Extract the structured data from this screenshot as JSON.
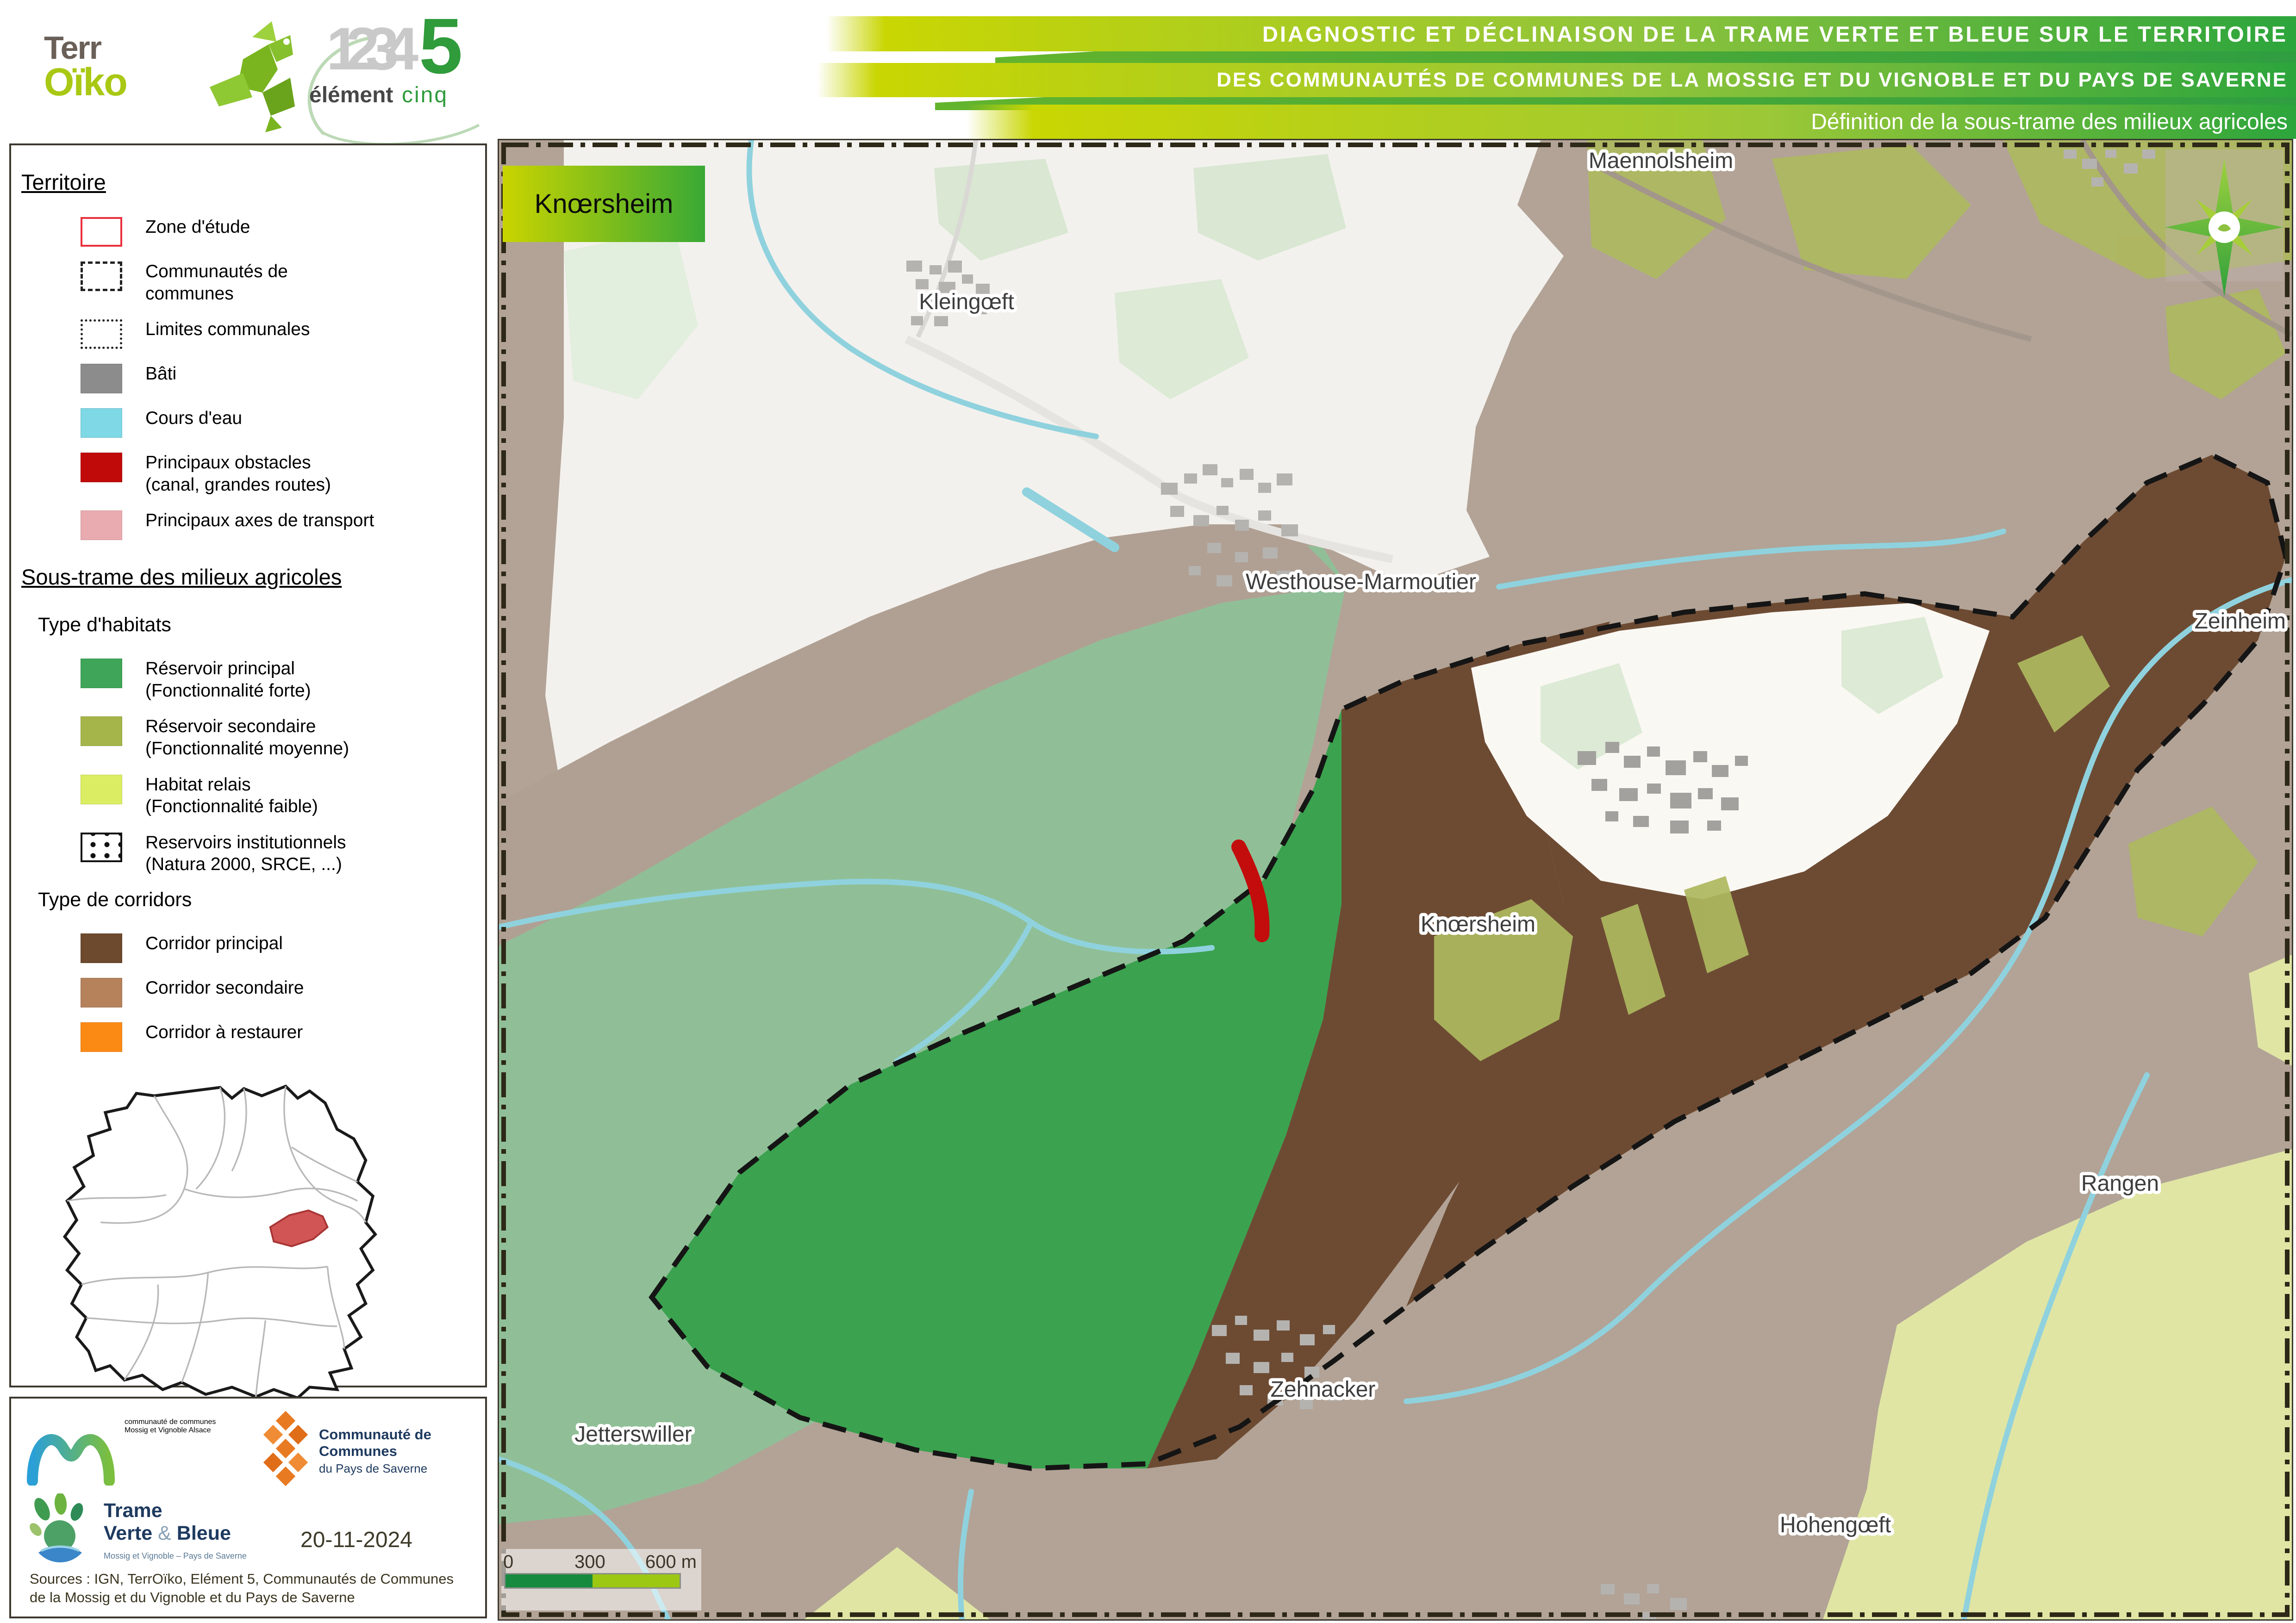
{
  "header": {
    "logo_terroiko": {
      "part1": "Terr",
      "part2": "Oïko"
    },
    "logo_element5": {
      "numbers": "1234",
      "five": "5",
      "word1": "élément",
      "word2": "cinq"
    },
    "title_line1": "DIAGNOSTIC ET DÉCLINAISON DE LA TRAME VERTE ET BLEUE SUR LE TERRITOIRE",
    "title_line2": "DES COMMUNAUTÉS DE COMMUNES DE LA MOSSIG ET DU VIGNOBLE ET DU PAYS DE SAVERNE",
    "title_line3": "Définition de la sous-trame des milieux agricoles"
  },
  "legend": {
    "territoire": {
      "title": "Territoire",
      "items": [
        {
          "label": "Zone d'étude",
          "swatch": "outline-red",
          "color": "#e8303c"
        },
        {
          "label": "Communautés de communes",
          "swatch": "dashed",
          "color": "#222222"
        },
        {
          "label": "Limites communales",
          "swatch": "dotted",
          "color": "#222222"
        },
        {
          "label": "Bâti",
          "swatch": "fill",
          "color": "#8c8c8c"
        },
        {
          "label": "Cours d'eau",
          "swatch": "fill",
          "color": "#7fd8e5"
        },
        {
          "label": "Principaux obstacles",
          "sublabel": "(canal, grandes routes)",
          "swatch": "fill",
          "color": "#c00a0a"
        },
        {
          "label": "Principaux axes de transport",
          "swatch": "fill",
          "color": "#e9abb0"
        }
      ]
    },
    "soustrame": {
      "title": "Sous-trame des milieux agricoles",
      "habitats": {
        "title": "Type d'habitats",
        "items": [
          {
            "label": "Réservoir principal",
            "sublabel": "(Fonctionnalité forte)",
            "color": "#3fa558"
          },
          {
            "label": "Réservoir secondaire",
            "sublabel": "(Fonctionnalité moyenne)",
            "color": "#a6b549"
          },
          {
            "label": "Habitat relais",
            "sublabel": "(Fonctionnalité faible)",
            "color": "#dbed62"
          },
          {
            "label": "Reservoirs institutionnels",
            "sublabel": "(Natura 2000, SRCE, ...)",
            "swatch": "dots"
          }
        ]
      },
      "corridors": {
        "title": "Type de corridors",
        "items": [
          {
            "label": "Corridor principal",
            "color": "#6d4a2d"
          },
          {
            "label": "Corridor secondaire",
            "color": "#b5825c"
          },
          {
            "label": "Corridor à restaurer",
            "color": "#fb8a15"
          }
        ]
      }
    }
  },
  "map": {
    "title_box": "Knœrsheim",
    "labels": {
      "maennolsheim": "Maennolsheim",
      "kleingoeft": "Kleingœft",
      "westhouse": "Westhouse-Marmoutier",
      "zeinheim": "Zeinheim",
      "knoersheim": "Knœrsheim",
      "rangen": "Rangen",
      "jetterswiller": "Jetterswiller",
      "zehnacker": "Zehnacker",
      "hohengoeft": "Hohengœft"
    },
    "scalebar": {
      "t0": "0",
      "t300": "300",
      "t600": "600 m"
    },
    "colors": {
      "corridor_secondaire_bg": "#b2a396",
      "corridor_principal": "#6d4b33",
      "reservoir_principal": "#3ba24f",
      "reservoir_principal_hors_zone": "#90bf97",
      "reservoir_secondaire": "#aeb85e",
      "habitat_relais": "#e0e5a4",
      "cours_eau": "#8fd2de",
      "obstacle": "#c30d0d",
      "hors_zone": "#f3f1ed"
    }
  },
  "footer": {
    "logo_mossig": {
      "top": "communauté de communes",
      "name1": "Mossig",
      "et": "et",
      "name2": "Vignoble",
      "region": "Alsace"
    },
    "logo_saverne": {
      "line1": "Communauté de Communes",
      "line2": "du Pays de Saverne"
    },
    "logo_tvb": {
      "line1": "Trame",
      "line2a": "Verte",
      "amp": "&",
      "line2b": "Bleue",
      "subtitle": "Mossig et Vignoble – Pays de Saverne"
    },
    "date": "20-11-2024",
    "sources": "Sources : IGN, TerrOïko, Elément 5, Communautés de Communes de la Mossig et du Vignoble et du Pays de Saverne"
  }
}
